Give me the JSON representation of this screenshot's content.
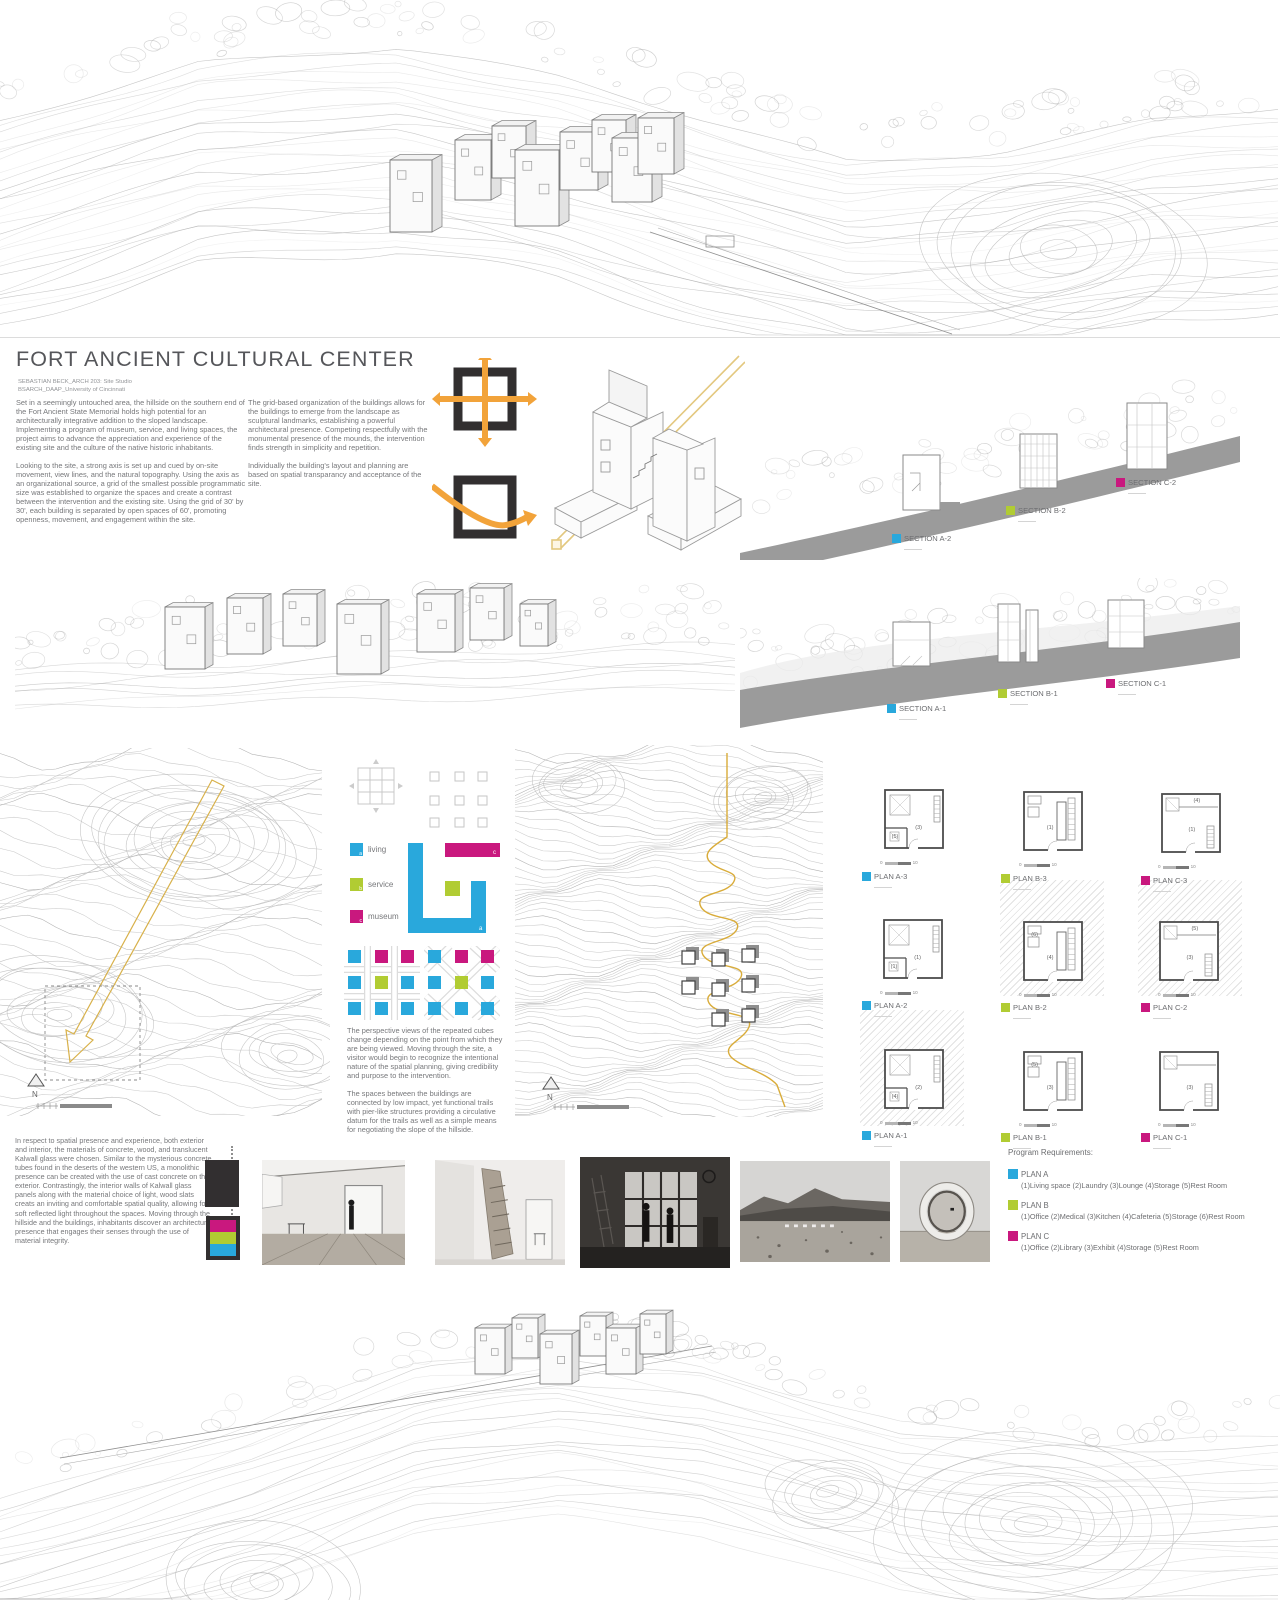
{
  "title": "FORT ANCIENT CULTURAL CENTER",
  "author_line1": "SEBASTIAN BECK_ARCH 203: Site Studio",
  "author_line2": "BSARCH_DAAP_University of Cincinnati",
  "intro": {
    "c1p1": "Set in a seemingly untouched area, the hillside on the southern end of the Fort Ancient State Memorial holds high potential for an architecturally integrative addition to the sloped landscape. Implementing a program of museum, service, and living spaces, the project aims to advance the appreciation and experience of the existing site and the culture of the native historic inhabitants.",
    "c1p2": "Looking to the site, a strong axis is set up and cued by on-site movement, view lines, and the natural topography. Using the axis as an organizational source, a grid of the smallest possible programmatic size was established to organize the spaces and create a contrast between the intervention and the existing site. Using the grid of 30' by 30', each building is separated by open spaces of 60', promoting openness, movement, and engagement within the site.",
    "c2p1": "The grid-based organization of the buildings allows for the buildings to emerge from the landscape as sculptural landmarks, establishing a powerful architectural presence. Competing respectfully with the monumental presence of the mounds, the intervention finds strength in simplicity and repetition.",
    "c2p2": "Individually the building's layout and planning are based on spatial transparancy and acceptance of the site."
  },
  "colors": {
    "blue": "#29a8dc",
    "green": "#b1cc33",
    "magenta": "#c9187e",
    "orange": "#f2a33a",
    "trail": "#d9ac3a",
    "dark": "#322f30",
    "band": "#9b9b9b"
  },
  "sections": {
    "top": [
      {
        "label": "SECTION A-2",
        "color": "blue"
      },
      {
        "label": "SECTION B-2",
        "color": "green"
      },
      {
        "label": "SECTION C-2",
        "color": "magenta"
      }
    ],
    "bottom": [
      {
        "label": "SECTION A-1",
        "color": "blue"
      },
      {
        "label": "SECTION B-1",
        "color": "green"
      },
      {
        "label": "SECTION C-1",
        "color": "magenta"
      }
    ]
  },
  "legend": [
    {
      "key": "a",
      "label": "living",
      "color": "blue"
    },
    {
      "key": "b",
      "label": "service",
      "color": "green"
    },
    {
      "key": "c",
      "label": "museum",
      "color": "magenta"
    }
  ],
  "diagram_text": {
    "p1": "The perspective views of the repeated cubes change depending on the point from which they are being viewed. Moving through the site, a visitor would begin to recognize the intentional nature of the spatial planning, giving credibility and purpose to the intervention.",
    "p2": "The spaces between the buildings are connected by low impact, yet functional trails with pier-like structures providing a circulative datum for the trails as well as a simple means for negotiating the slope of the hillside."
  },
  "plans": [
    {
      "label": "PLAN A-3",
      "color": "blue",
      "rooms": [
        "(3)",
        "(5)"
      ]
    },
    {
      "label": "PLAN B-3",
      "color": "green",
      "rooms": [
        "(1)"
      ]
    },
    {
      "label": "PLAN C-3",
      "color": "magenta",
      "rooms": [
        "(1)",
        "(4)"
      ]
    },
    {
      "label": "PLAN A-2",
      "color": "blue",
      "rooms": [
        "(1)",
        "(1)"
      ]
    },
    {
      "label": "PLAN B-2",
      "color": "green",
      "rooms": [
        "(4)",
        "(6)"
      ]
    },
    {
      "label": "PLAN C-2",
      "color": "magenta",
      "rooms": [
        "(3)",
        "(5)"
      ]
    },
    {
      "label": "PLAN A-1",
      "color": "blue",
      "rooms": [
        "(2)",
        "(4)"
      ]
    },
    {
      "label": "PLAN B-1",
      "color": "green",
      "rooms": [
        "(3)",
        "(5)"
      ]
    },
    {
      "label": "PLAN C-1",
      "color": "magenta",
      "rooms": [
        "(3)"
      ]
    }
  ],
  "plan_scale": {
    "zero": "0",
    "ten": "10"
  },
  "compass": {
    "n": "N"
  },
  "materials_text": "In respect to spatial presence and experience, both exterior and interior, the materials of concrete, wood, and translucent Kalwall glass were chosen. Similar to the mysterious concrete tubes found in the deserts of the western US, a monolithic presence can be created with the use of cast concrete on the exterior. Contrastingly, the interior walls of Kalwall glass panels along with the material choice of light, wood slats creats an inviting and comfortable spatial quality, allowing for soft reflected light throughout the spaces. Moving through the hillside and the buildings, inhabitants discover an architectural presence that engages their senses through the use of material integrity.",
  "program": {
    "heading": "Program Requirements:",
    "plans": [
      {
        "name": "PLAN A",
        "color": "blue",
        "items": "(1)Living space (2)Laundry (3)Lounge (4)Storage (5)Rest Room"
      },
      {
        "name": "PLAN B",
        "color": "green",
        "items": "(1)Office (2)Medical (3)Kitchen (4)Cafeteria (5)Storage (6)Rest Room"
      },
      {
        "name": "PLAN C",
        "color": "magenta",
        "items": "(1)Office (2)Library (3)Exhibit (4)Storage (5)Rest Room"
      }
    ]
  }
}
